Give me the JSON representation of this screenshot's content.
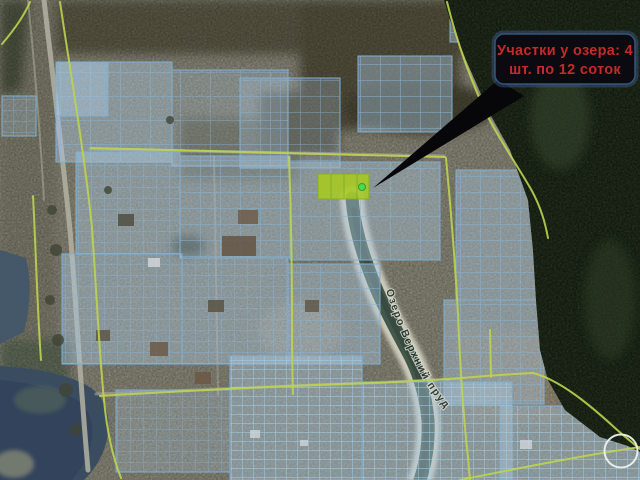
{
  "image": {
    "kind": "satellite-cadastral-map-with-sale-annotation",
    "width": 640,
    "height": 480
  },
  "callout": {
    "line1": "Участки у озера: 4",
    "line2": "шт. по 12 соток",
    "text_color": "#c62a28",
    "box_color": "#0a0a10",
    "border_color": "#3c5a8a",
    "arrow_color": "#07070a"
  },
  "map": {
    "water_label": "Озеро Верхний пруд",
    "highlighted_plots": {
      "count": 4,
      "area_per_plot": "12 соток",
      "fill": "#a9cc1c",
      "stroke": "#86b014",
      "marker_color": "#3ee838"
    },
    "colors": {
      "parcel_line": "#86b3d6",
      "parcel_line_bright": "#a2d2ec",
      "boundary_line": "#bdd44e",
      "forest": "#26331f",
      "lake": "#3a4d60",
      "river": "#41584a",
      "sand": "#d9d5c6",
      "field": "#8b897a",
      "highlight_circle": "#edf2ec"
    }
  }
}
